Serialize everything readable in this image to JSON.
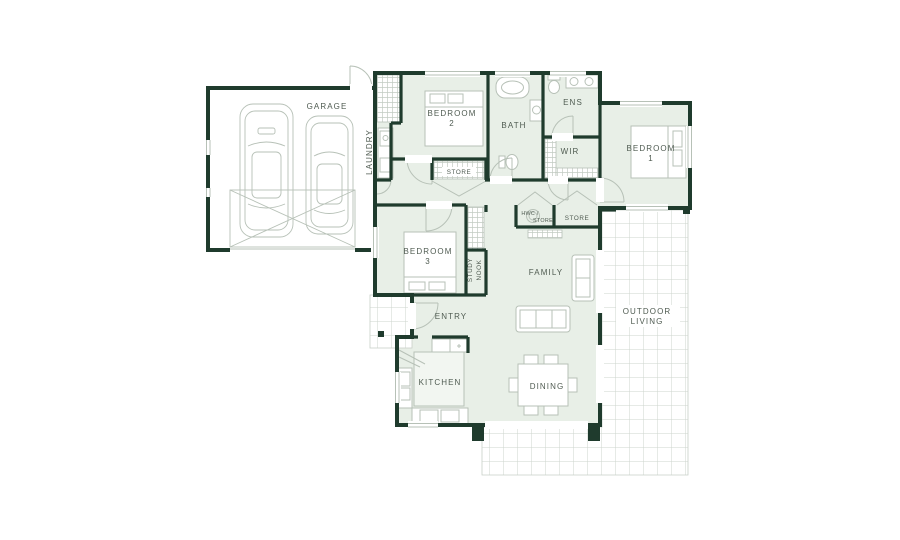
{
  "plan": {
    "type": "residential-floor-plan",
    "colors": {
      "wall": "#1f3b2d",
      "floor": "#e8efe7",
      "linework": "#b7c1b7",
      "tile_line": "#cdd4cd",
      "label_text": "#4f5b51",
      "background": "#ffffff"
    },
    "rooms": {
      "garage": {
        "label": "GARAGE"
      },
      "laundry": {
        "label": "LAUNDRY"
      },
      "bedroom2": {
        "label": "BEDROOM",
        "number": "2"
      },
      "bath": {
        "label": "BATH"
      },
      "ens": {
        "label": "ENS"
      },
      "wir": {
        "label": "WIR"
      },
      "bedroom1": {
        "label": "BEDROOM",
        "number": "1"
      },
      "store_hall": {
        "label": "STORE"
      },
      "hwc": {
        "label_line1": "HWC /",
        "label_line2": "STORE"
      },
      "store_family": {
        "label": "STORE"
      },
      "bedroom3": {
        "label": "BEDROOM",
        "number": "3"
      },
      "study_nook": {
        "label_line1": "STUDY",
        "label_line2": "NOOK"
      },
      "family": {
        "label": "FAMILY"
      },
      "entry": {
        "label": "ENTRY"
      },
      "kitchen": {
        "label": "KITCHEN"
      },
      "dining": {
        "label": "DINING"
      },
      "outdoor": {
        "label_line1": "OUTDOOR",
        "label_line2": "LIVING"
      }
    }
  }
}
